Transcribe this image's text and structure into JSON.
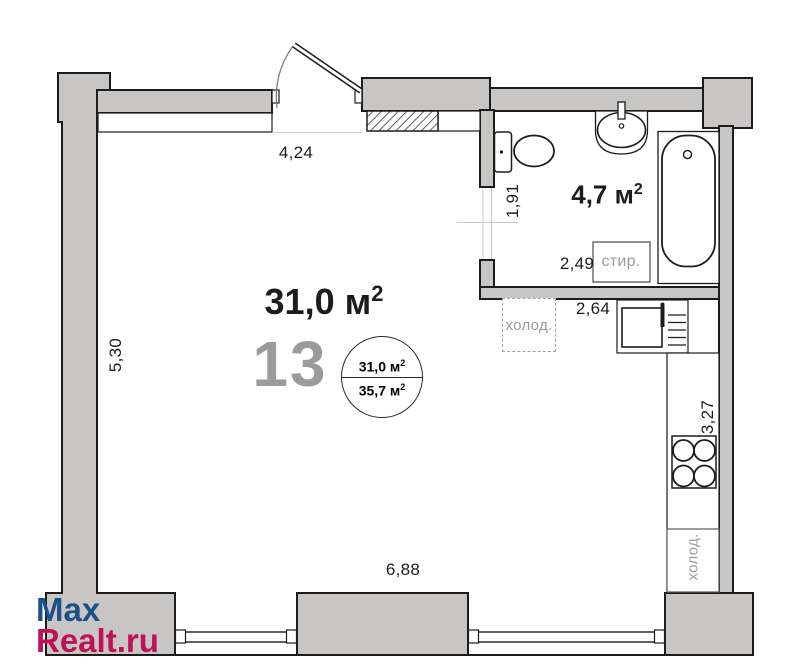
{
  "unit": {
    "number": "13"
  },
  "areas": {
    "main_room": {
      "value": "31,0 м",
      "sup": "2"
    },
    "bathroom": {
      "value": "4,7 м",
      "sup": "2"
    },
    "badge": {
      "living": {
        "value": "31,0 м",
        "sup": "2"
      },
      "total": {
        "value": "35,7 м",
        "sup": "2"
      }
    }
  },
  "dimensions": {
    "top": "4,24",
    "left": "5,30",
    "bottom": "6,88",
    "bath_height": "1,91",
    "bath_width": "2,49",
    "kitchen_width": "2,64",
    "kitchen_height": "3,27"
  },
  "appliances": {
    "washer": "стир.",
    "fridge": "холод.",
    "fridge_lower": "холод."
  },
  "watermark": {
    "line1": "Max",
    "line2": "Realt.ru"
  },
  "colors": {
    "wall_fill": "#c7c6c5",
    "outline": "#1c1c1c",
    "muted_text": "#9b9b9b",
    "watermark_blue": "#1d4f8b",
    "watermark_red": "#c01057"
  }
}
